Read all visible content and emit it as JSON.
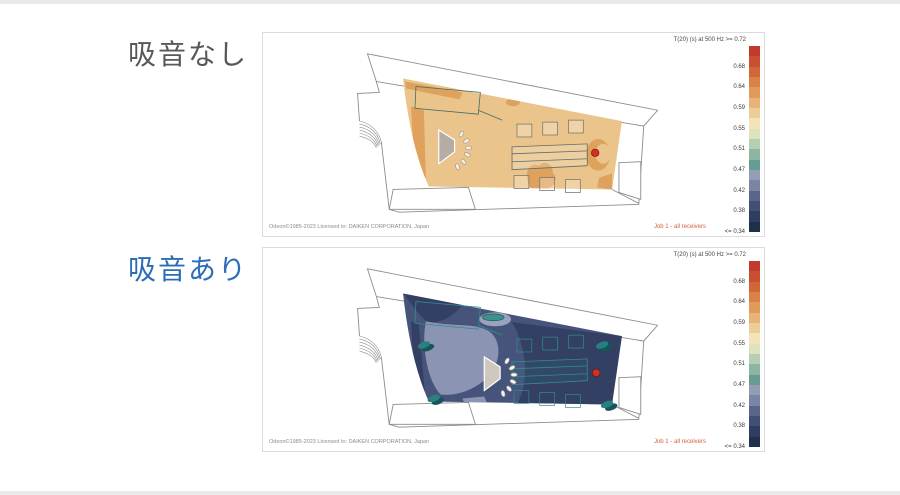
{
  "page": {
    "background": "#ffffff",
    "edge_strip_color": "#e9e9e9"
  },
  "panels": [
    {
      "id": "no-absorption",
      "label": "吸音なし",
      "label_color": "#58585a",
      "legend_title": "T(20) (s)  at 500 Hz  >= 0.72",
      "footer_left": "Odeon©1985-2023   Licensed to: DAIKEN CORPORATION, Japan",
      "footer_right": "Job 1 - all receivers",
      "dominant_result_color": "#eac48a"
    },
    {
      "id": "with-absorption",
      "label": "吸音あり",
      "label_color": "#2d6db7",
      "legend_title": "T(20) (s)  at 500 Hz  >= 0.72",
      "footer_left": "Odeon©1985-2023   Licensed to: DAIKEN CORPORATION, Japan",
      "footer_right": "Job 1 - all receivers",
      "dominant_result_color": "#3d4b70"
    }
  ],
  "colorbar": {
    "top_value": ">= 0.72",
    "labels": [
      "0.68",
      "0.64",
      "0.59",
      "0.55",
      "0.51",
      "0.47",
      "0.42",
      "0.38"
    ],
    "bottom_label": "<= 0.34",
    "colors": [
      "#c13a2b",
      "#ca4f31",
      "#d26639",
      "#da8148",
      "#e09b5b",
      "#e7b377",
      "#edcd97",
      "#f2e4b8",
      "#dfe3bd",
      "#b4cfb3",
      "#8cb5a4",
      "#679c92",
      "#949db6",
      "#7a84a4",
      "#5a6689",
      "#414f76",
      "#2e3d60",
      "#20304a"
    ],
    "quantity": "T(20) (s) at 500 Hz"
  },
  "icons": {
    "sound_source": "loudspeaker-with-sound-waves",
    "receiver": "red-dot",
    "receiver_color": "#d03220"
  }
}
